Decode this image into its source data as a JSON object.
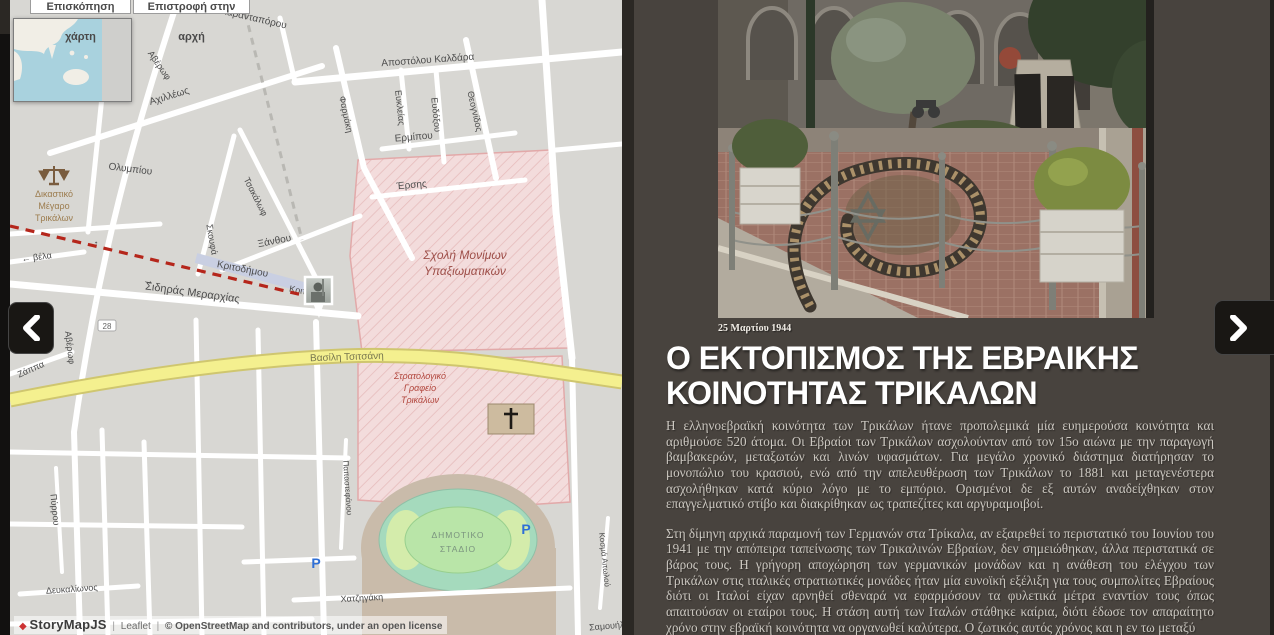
{
  "map": {
    "buttons": [
      {
        "label": "Επισκόπηση χάρτη"
      },
      {
        "label": "Επιστροφή στην αρχή"
      }
    ],
    "attribution": {
      "diamond": "◆",
      "brand": "StoryMapJS",
      "sep": "|",
      "leaflet": "Leaflet",
      "osm_text": "© OpenStreetMap and contributors, under an ",
      "license_text": "open license"
    },
    "street_labels": [
      {
        "t": "Καρανταπόρου",
        "x": 243,
        "y": 21,
        "r": 13,
        "s": 10
      },
      {
        "t": "Αποστόλου Καλδάρα",
        "x": 418,
        "y": 63,
        "r": -4,
        "s": 10
      },
      {
        "t": "Ερμίπου",
        "x": 404,
        "y": 140,
        "r": -5,
        "s": 10
      },
      {
        "t": "Έρσης",
        "x": 402,
        "y": 188,
        "r": -5,
        "s": 10
      },
      {
        "t": "Ευκλείας",
        "x": 387,
        "y": 108,
        "r": 84,
        "s": 9
      },
      {
        "t": "Ευδόξου",
        "x": 423,
        "y": 115,
        "r": 84,
        "s": 9
      },
      {
        "t": "Θεογνίδος",
        "x": 462,
        "y": 112,
        "r": 77,
        "s": 9
      },
      {
        "t": "Φαρμάκη",
        "x": 333,
        "y": 115,
        "r": 78,
        "s": 9
      },
      {
        "t": "Αχιλλέως",
        "x": 160,
        "y": 99,
        "r": -17,
        "s": 10
      },
      {
        "t": "Ολυμπίου",
        "x": 120,
        "y": 172,
        "r": 7,
        "s": 10
      },
      {
        "t": "Αβέρωφ",
        "x": 147,
        "y": 67,
        "r": 55,
        "s": 9
      },
      {
        "t": "Αβέρωφ",
        "x": 57,
        "y": 348,
        "r": 83,
        "s": 9
      },
      {
        "t": "Σκουφά",
        "x": 199,
        "y": 240,
        "r": 80,
        "s": 9
      },
      {
        "t": "Τσακάλωφ",
        "x": 243,
        "y": 198,
        "r": 63,
        "s": 9
      },
      {
        "t": "Ξάνθου",
        "x": 265,
        "y": 244,
        "r": -11,
        "s": 10
      },
      {
        "t": "Κριτοδήμου",
        "x": 232,
        "y": 272,
        "r": 11,
        "s": 10
      },
      {
        "t": "Κριτ",
        "x": 287,
        "y": 293,
        "r": 11,
        "s": 9
      },
      {
        "t": "Σιδηράς Μεραρχίας",
        "x": 182,
        "y": 296,
        "r": 8,
        "s": 11
      },
      {
        "t": "→",
        "x": 138,
        "y": 284,
        "r": 8,
        "s": 11
      },
      {
        "t": "← βέλα",
        "x": 27,
        "y": 260,
        "r": -7,
        "s": 9
      },
      {
        "t": "↑",
        "x": 86,
        "y": 247,
        "r": 0,
        "s": 10
      },
      {
        "t": "Ζάππα",
        "x": 22,
        "y": 372,
        "r": -24,
        "s": 9
      },
      {
        "t": "Βασίλη Τσιτσάνη",
        "x": 337,
        "y": 360,
        "r": -2,
        "s": 10,
        "c": "#77764f"
      },
      {
        "t": "Πύρρου",
        "x": 42,
        "y": 510,
        "r": 84,
        "s": 9
      },
      {
        "t": "Δευκαλίωνος",
        "x": 62,
        "y": 592,
        "r": -4,
        "s": 9
      },
      {
        "t": "Χατζηγάκη",
        "x": 352,
        "y": 601,
        "r": -3,
        "s": 9
      },
      {
        "t": "Παπαστεφάνου",
        "x": 335,
        "y": 488,
        "r": 86,
        "s": 8
      },
      {
        "t": "Κοσμά Αιτωλού",
        "x": 592,
        "y": 560,
        "r": 84,
        "s": 8
      },
      {
        "t": "Σαμουήλ",
        "x": 597,
        "y": 629,
        "r": -5,
        "s": 9
      }
    ],
    "poi_labels": [
      {
        "t": "Σχολή Μονίμων",
        "x": 455,
        "y": 259,
        "s": 12,
        "c": "#9e4f49",
        "i": 1
      },
      {
        "t": "Υπαξιωματικών",
        "x": 455,
        "y": 275,
        "s": 12,
        "c": "#9e4f49",
        "i": 1
      },
      {
        "t": "Στρατολογικό",
        "x": 410,
        "y": 379,
        "s": 9,
        "c": "#b2473e",
        "i": 1
      },
      {
        "t": "Γραφείο",
        "x": 410,
        "y": 391,
        "s": 9,
        "c": "#b2473e",
        "i": 1
      },
      {
        "t": "Τρικάλων",
        "x": 410,
        "y": 403,
        "s": 9,
        "c": "#b2473e",
        "i": 1
      },
      {
        "t": "Δικαστικό",
        "x": 44,
        "y": 197,
        "s": 9,
        "c": "#9c7c4e"
      },
      {
        "t": "Μέγαρο",
        "x": 44,
        "y": 209,
        "s": 9,
        "c": "#9c7c4e"
      },
      {
        "t": "Τρικάλων",
        "x": 44,
        "y": 221,
        "s": 9,
        "c": "#9c7c4e"
      },
      {
        "t": "ΔΗΜΟΤΙΚΟ",
        "x": 448,
        "y": 538,
        "s": 8.5,
        "c": "#7b947f",
        "ls": 1
      },
      {
        "t": "ΣΤΑΔΙΟ",
        "x": 448,
        "y": 552,
        "s": 8.5,
        "c": "#7b947f",
        "ls": 1
      },
      {
        "t": "P",
        "x": 516,
        "y": 534,
        "s": 14,
        "c": "#2f6fd6",
        "b": 1
      },
      {
        "t": "P",
        "x": 306,
        "y": 568,
        "s": 14,
        "c": "#2f6fd6",
        "b": 1
      },
      {
        "t": "28",
        "x": 97,
        "y": 329,
        "s": 8,
        "c": "#666666"
      }
    ],
    "colors": {
      "route_line": "#b5261b",
      "military_area": "#f3dcdc",
      "main_road": "#f4f08f",
      "stadium_track": "#a5dabd"
    }
  },
  "nav": {
    "prev_icon": "chevron-left-icon",
    "next_icon": "chevron-right-icon"
  },
  "panel": {
    "caption": "25 Μαρτίου 1944",
    "title": "Ο ΕΚΤΟΠΙΣΜΟΣ ΤΗΣ ΕΒΡΑΙΚΗΣ ΚΟΙΝΟΤΗΤΑΣ ΤΡΙΚΑΛΩΝ",
    "paragraphs": [
      "Η ελληνοεβραϊκή κοινότητα των Τρικάλων ήτανε προπολεμικά μία ευημερούσα κοινότητα και αριθμούσε 520 άτομα. Οι Εβραίοι των Τρικάλων ασχολούνταν από τον 15ο αιώνα με την παραγωγή βαμβακερών, μεταξωτών και λινών υφασμάτων. Για μεγάλο χρονικό διάστημα διατήρησαν το μονοπώλιο του κρασιού, ενώ από την απελευθέρωση των Τρικάλων το 1881 και μεταγενέστερα ασχολήθηκαν κατά κύριο λόγο με το εμπόριο. Ορισμένοι δε εξ αυτών αναδείχθηκαν στον επαγγελματικό στίβο και διακρίθηκαν ως τραπεζίτες και αργυραμοιβοί.",
      "Στη δίμηνη αρχικά παραμονή των Γερμανών στα Τρίκαλα, αν εξαιρεθεί το περιστατικό του Ιουνίου του 1941 με την απόπειρα ταπείνωσης των Τρικαλινών Εβραίων, δεν σημειώθηκαν, άλλα περιστατικά σε βάρος τους. Η γρήγορη αποχώρηση των γερμανικών μονάδων και η ανάθεση του ελέγχου των Τρικάλων στις ιταλικές στρατιωτικές μονάδες ήταν μία ευνοϊκή εξέλιξη για τους συμπολίτες Εβραίους διότι οι Ιταλοί είχαν αρνηθεί σθεναρά να εφαρμόσουν τα φυλετικά μέτρα εναντίον τους όπως απαιτούσαν οι εταίροι τους. Η στάση αυτή των Ιταλών στάθηκε καίρια, διότι έδωσε τον απαραίτητο χρόνο στην εβραϊκή κοινότητα να οργανωθεί καλύτερα. Ο ζωτικός αυτός χρόνος και η εν τω μεταξύ"
    ]
  }
}
